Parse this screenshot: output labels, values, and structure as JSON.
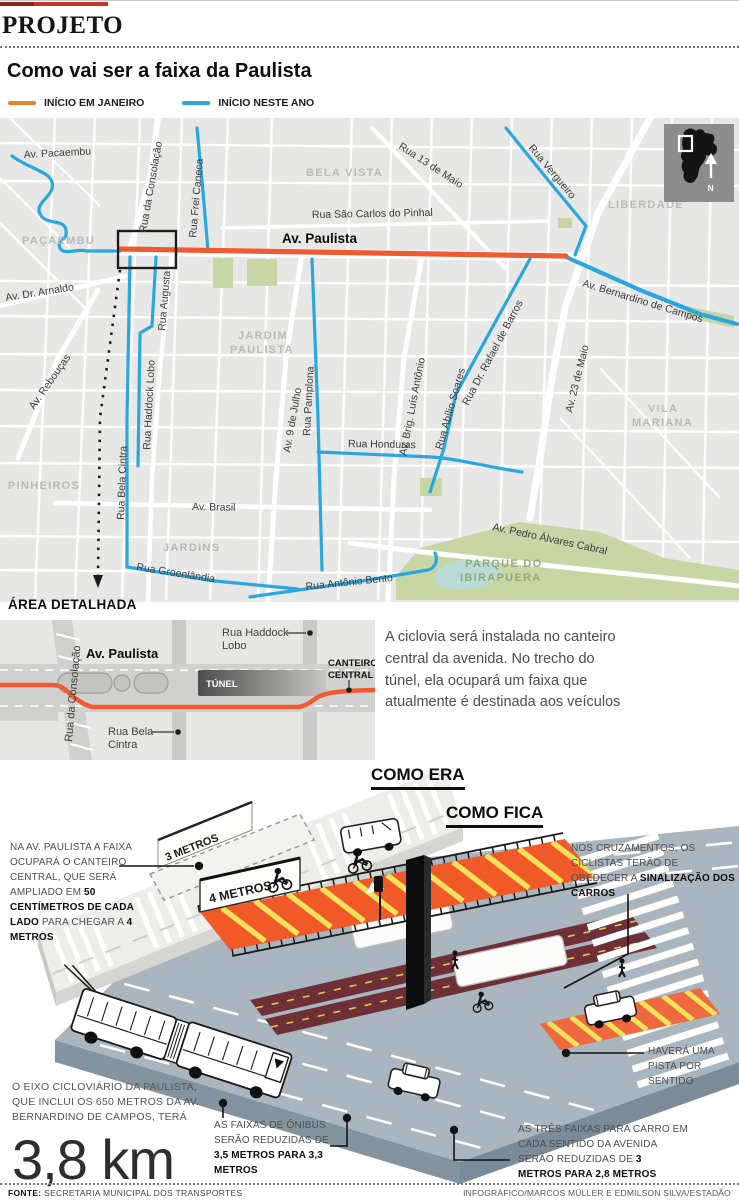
{
  "kicker": "PROJETO",
  "title": "Como vai ser a faixa da Paulista",
  "legend": {
    "january": "INÍCIO EM JANEIRO",
    "this_year": "INÍCIO NESTE ANO"
  },
  "colors": {
    "accent_red": "#c2332c",
    "route_orange": "#f05a30",
    "route_blue": "#2aa7de",
    "map_bg": "#e7e7e5",
    "road_gray": "#a9b6c0",
    "bike_orange": "#f05a28",
    "stripe_yellow": "#f2e15a"
  },
  "map": {
    "streets": {
      "pacaembu": "Av. Pacaembu",
      "consolacao": "Rua da Consolação",
      "frei_caneca": "Rua Frei Caneca",
      "sao_carlos": "Rua São Carlos do Pinhal",
      "treze_maio": "Rua 13 de Maio",
      "vergueiro": "Rua Vergueiro",
      "paulista": "Av. Paulista",
      "bernardino": "Av. Bernardino de Campos",
      "arnaldo": "Av. Dr. Arnaldo",
      "augusta": "Rua Augusta",
      "haddock": "Rua Haddock Lobo",
      "bela_cintra": "Rua Bela Cintra",
      "pamplona": "Rua Pamplona",
      "nove_julho": "Av. 9 de Julho",
      "brig_luis": "Av. Brig. Luís Antônio",
      "rafael_barros": "Rua Dr. Rafael de Barros",
      "abilio_soares": "Rua Abílio Soares",
      "vinte_tres_maio": "Av. 23 de Maio",
      "reboucas": "Av. Rebouças",
      "honduras": "Rua Honduras",
      "brasil": "Av. Brasil",
      "groenlandia": "Rua Groenlândia",
      "antonio_bento": "Rua Antônio Bento",
      "pedro_cabral": "Av. Pedro Álvares Cabral"
    },
    "districts": {
      "pacaembu": "PAÇAEMBU",
      "bela_vista": "BELA VISTA",
      "liberdade": "LIBERDADE",
      "jardim_1": "JARDIM",
      "jardim_2": "PAULISTA",
      "pinheiros": "PINHEIROS",
      "jardins": "JARDINS",
      "vila_1": "VILA",
      "vila_2": "MARIANA",
      "parque_1": "PARQUE DO",
      "parque_2": "IBIRAPUERA"
    },
    "inset": {
      "north": "N"
    }
  },
  "detail": {
    "heading": "ÁREA DETALHADA",
    "streets": {
      "consolacao": "Rua da Consolação",
      "paulista": "Av. Paulista",
      "tunnel": "TÚNEL",
      "haddock_line1": "Rua Haddock",
      "haddock_line2": "Lobo",
      "bela_line1": "Rua Bela",
      "bela_line2": "Cintra",
      "canteiro_line1": "CANTEIRO",
      "canteiro_line2": "CENTRAL"
    },
    "paragraph": "A ciclovia será instalada no canteiro central da avenida. No trecho do túnel, ela ocupará um faixa que atualmente é destinada aos veículos"
  },
  "diagram": {
    "before_label": "COMO ERA",
    "after_label": "COMO FICA",
    "old_median_width": "3 METROS",
    "new_median_width": "4 METROS",
    "notes": {
      "median": [
        {
          "t": "NA AV. PAULISTA A FAIXA OCUPARÁ O CANTEIRO CENTRAL, QUE SERÁ AMPLIADO EM "
        },
        {
          "t": "50 CENTÍMETROS DE CADA LADO",
          "b": true
        },
        {
          "t": " PARA CHEGAR A "
        },
        {
          "t": "4 METROS",
          "b": true
        }
      ],
      "crossings": [
        {
          "t": "NOS CRUZAMENTOS, OS CICLISTAS TERÃO DE OBEDECER A "
        },
        {
          "t": "SINALIZAÇÃO DOS CARROS",
          "b": true
        }
      ],
      "one_lane": [
        {
          "t": "HAVERÁ UMA PISTA POR SENTIDO"
        }
      ],
      "bus_lanes": [
        {
          "t": "AS FAIXAS DE ÔNIBUS SERÃO REDUZIDAS DE "
        },
        {
          "t": "3,5 METROS PARA 3,3 METROS",
          "b": true
        }
      ],
      "car_lanes": [
        {
          "t": "AS TRÊS FAIXAS PARA CARRO EM CADA SENTIDO DA AVENIDA SERÃO REDUZIDAS DE "
        },
        {
          "t": "3 METROS PARA 2,8 METROS",
          "b": true
        }
      ]
    },
    "stat": {
      "intro": "O EIXO CICLOVIÁRIO DA PAULISTA, QUE INCLUI OS 650 METROS DA AV. BERNARDINO DE CAMPOS, TERÁ",
      "value": "3,8 km"
    }
  },
  "footer": {
    "source_label": "FONTE:",
    "source": "SECRETARIA MUNICIPAL DOS TRANSPORTES",
    "credit": "INFOGRÁFICO/MARCOS MÜLLER E EDMILSON SILVA/ESTADÃO"
  }
}
